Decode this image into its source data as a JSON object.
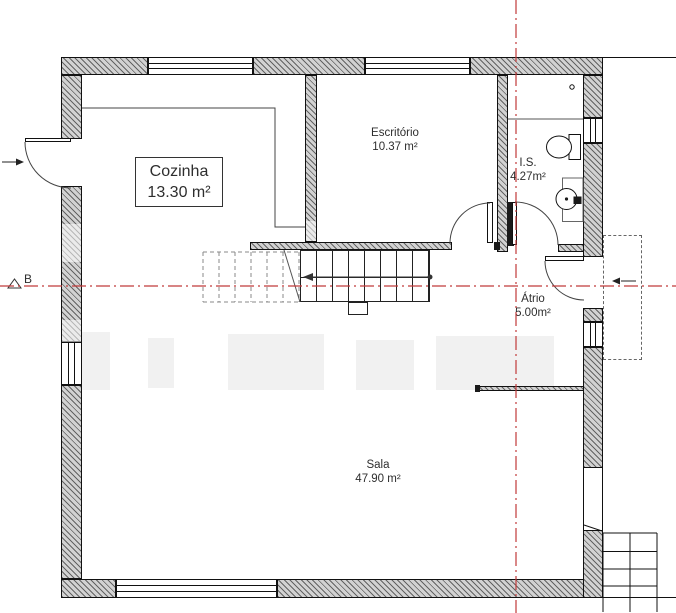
{
  "plan": {
    "title_note": "floor plan",
    "rooms": {
      "cozinha": {
        "name": "Cozinha",
        "area": "13.30 m²"
      },
      "escritorio": {
        "name": "Escritório",
        "area": "10.37 m²"
      },
      "is": {
        "name": "I.S.",
        "area": "4.27m²"
      },
      "atrio": {
        "name": "Átrio",
        "area": "5.00m²"
      },
      "sala": {
        "name": "Sala",
        "area": "47.90 m²"
      }
    },
    "section_marker": {
      "label": "B"
    },
    "colors": {
      "section_line_red": "#c03a3a",
      "wall_hatch_gray": "#9a9a9a",
      "line_black": "#1a1a1a"
    }
  }
}
